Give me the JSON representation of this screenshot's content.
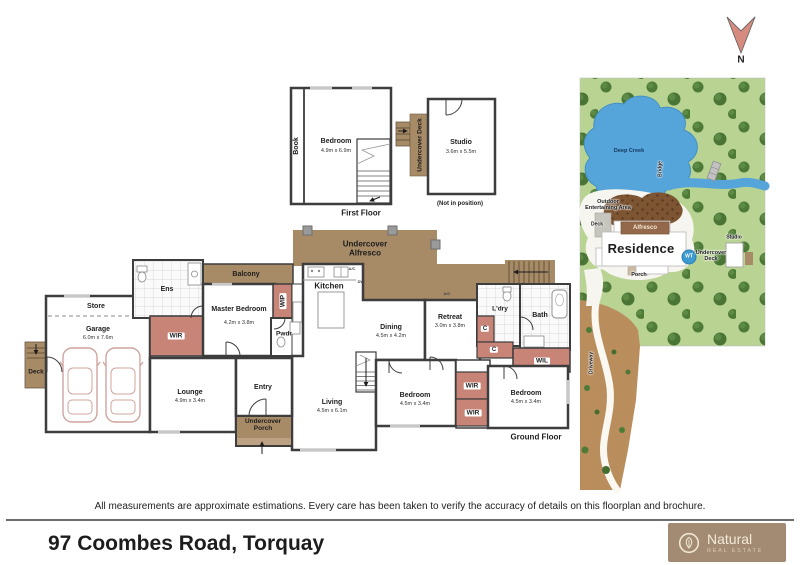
{
  "compass": {
    "label": "N"
  },
  "first_floor": {
    "title": "First Floor",
    "book": "Book",
    "bedroom_name": "Bedroom",
    "bedroom_dims": "4.9m x 6.9m"
  },
  "studio": {
    "deck": "Undercover Deck",
    "name": "Studio",
    "dims": "3.6m x 5.5m",
    "note": "(Not in position)"
  },
  "ground": {
    "title": "Ground Floor",
    "store": "Store",
    "garage_name": "Garage",
    "garage_dims": "6.0m x 7.6m",
    "deck": "Deck",
    "ens": "Ens",
    "wir": "WIR",
    "balcony": "Balcony",
    "master_name": "Master Bedroom",
    "master_dims": "4.2m x 3.8m",
    "wip": "WIP",
    "pwdr": "Pwdr",
    "kitchen": "Kitchen",
    "alfresco": "Undercover Alfresco",
    "ac": "A/C",
    "dw": "DW",
    "dining_name": "Dining",
    "dining_dims": "4.5m x 4.2m",
    "retreat_name": "Retreat",
    "retreat_dims": "3.0m x 3.8m",
    "ldry": "L'dry",
    "cupboard": "C",
    "bath": "Bath",
    "wil": "WIL",
    "lounge_name": "Lounge",
    "lounge_dims": "4.9m x 3.4m",
    "entry": "Entry",
    "porch": "Undercover Porch",
    "living_name": "Living",
    "living_dims": "4.5m x 6.1m",
    "bedroom2_name": "Bedroom",
    "bedroom2_dims": "4.5m x 3.4m",
    "bedroom3_name": "Bedroom",
    "bedroom3_dims": "4.5m x 3.4m"
  },
  "site_map": {
    "deep_creek": "Deep Creek",
    "bridge": "Bridge",
    "outdoor_area": "Outdoor Entertaining Area",
    "deck": "Deck",
    "alfresco": "Alfresco",
    "residence": "Residence",
    "water_tank": "WT",
    "undercover_deck": "Undercover Deck",
    "studio": "Studio",
    "porch": "Porch",
    "driveway": "Driveway"
  },
  "footer": {
    "disclaimer": "All measurements are approximate estimations. Every care has been taken to verify the accuracy of details on this floorplan and brochure.",
    "address": "97 Coombes Road, Torquay",
    "logo_name": "Natural",
    "logo_sub": "REAL ESTATE"
  },
  "colors": {
    "deck_brown": "#a78a66",
    "wardrobe_red": "#c98478",
    "map_green": "#b9d393",
    "creek_blue": "#55a4da",
    "driveway_tan": "#ba8d5d",
    "logo_bg": "#a28b72",
    "north_arrow": "#d78b7f"
  }
}
